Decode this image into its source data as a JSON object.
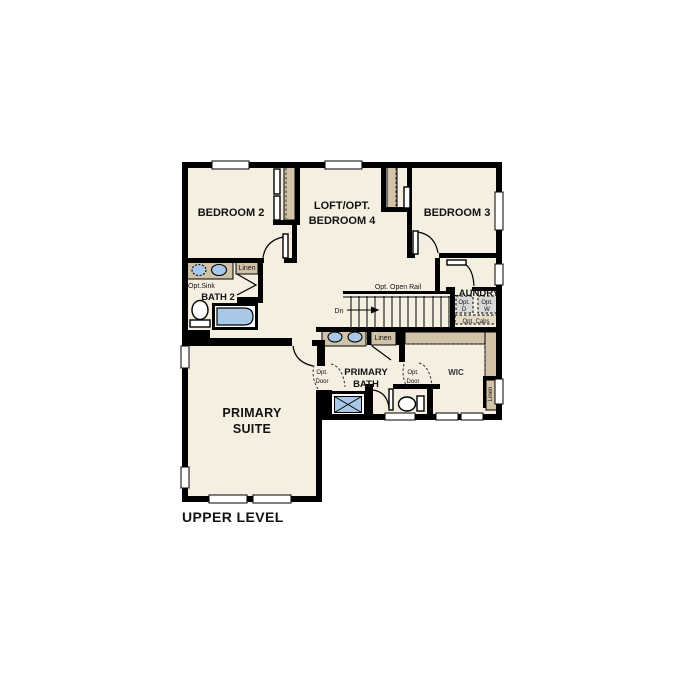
{
  "title": "UPPER LEVEL",
  "colors": {
    "floor": "#f5efe2",
    "wall": "#000000",
    "casework": "#d2c3a8",
    "fixture": "#a9c7e8",
    "appliance": "#d9d9d9"
  },
  "rooms": {
    "bedroom2": {
      "label": "BEDROOM 2"
    },
    "loft": {
      "line1": "LOFT/OPT.",
      "line2": "BEDROOM 4"
    },
    "bedroom3": {
      "label": "BEDROOM 3"
    },
    "bath2": {
      "label": "BATH 2",
      "opt_sink": "Opt.Sink",
      "linen": "Linen"
    },
    "stairs": {
      "rail": "Opt. Open Rail",
      "down": "Dn"
    },
    "laundry": {
      "label": "LAUNDRY",
      "dryer1": "Opt.",
      "dryer2": "D",
      "washer1": "Opt.",
      "washer2": "W",
      "cabs": "Opt. Cabs"
    },
    "primary_bath": {
      "line1": "PRIMARY",
      "line2": "BATH",
      "linen": "Linen",
      "opt_door1": "Opt.",
      "opt_door2": "Door"
    },
    "wic": {
      "label": "WIC",
      "linen": "Linen",
      "opt_door1": "Opt.",
      "opt_door2": "Door"
    },
    "primary_suite": {
      "line1": "PRIMARY",
      "line2": "SUITE"
    }
  }
}
